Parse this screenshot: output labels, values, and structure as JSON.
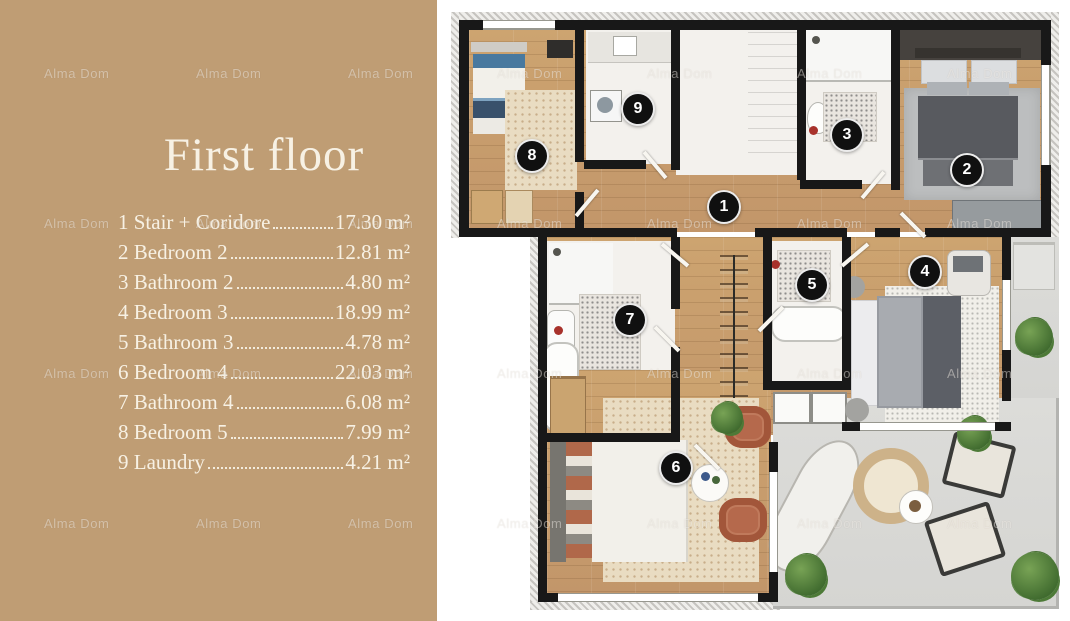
{
  "panel": {
    "title": "First floor",
    "legend": [
      {
        "num": "1",
        "label": "Stair + Coridore",
        "area": "17.30 m²"
      },
      {
        "num": "2",
        "label": "Bedroom 2",
        "area": "12.81 m²"
      },
      {
        "num": "3",
        "label": "Bathroom 2",
        "area": "4.80 m²"
      },
      {
        "num": "4",
        "label": "Bedroom 3",
        "area": "18.99 m²"
      },
      {
        "num": "5",
        "label": "Bathroom 3",
        "area": "4.78 m²"
      },
      {
        "num": "6",
        "label": "Bedroom 4",
        "area": "22.03 m²"
      },
      {
        "num": "7",
        "label": "Bathroom 4",
        "area": "6.08 m²"
      },
      {
        "num": "8",
        "label": "Bedroom 5",
        "area": "7.99 m²"
      },
      {
        "num": "9",
        "label": "Laundry",
        "area": "4.21 m²"
      }
    ]
  },
  "watermark": {
    "text": "Alma Dom"
  },
  "plan": {
    "markers": [
      {
        "n": "1",
        "room": "stair-coridore",
        "x": 269,
        "y": 197
      },
      {
        "n": "2",
        "room": "bedroom-2",
        "x": 512,
        "y": 160
      },
      {
        "n": "3",
        "room": "bathroom-2",
        "x": 392,
        "y": 125
      },
      {
        "n": "4",
        "room": "bedroom-3",
        "x": 470,
        "y": 262
      },
      {
        "n": "5",
        "room": "bathroom-3",
        "x": 357,
        "y": 275
      },
      {
        "n": "6",
        "room": "bedroom-4",
        "x": 221,
        "y": 458
      },
      {
        "n": "7",
        "room": "bathroom-4",
        "x": 175,
        "y": 310
      },
      {
        "n": "8",
        "room": "bedroom-5",
        "x": 77,
        "y": 146
      },
      {
        "n": "9",
        "room": "laundry",
        "x": 183,
        "y": 99
      }
    ]
  },
  "colors": {
    "panel_bg": "#bf9d74",
    "panel_text": "#f7f1e4",
    "wall": "#181818",
    "wood": "#c99e6b",
    "terrace": "#d9d9d6",
    "armchair_rust": "#b5694c",
    "accent_red": "#a8322c",
    "bed_blue": "#49799f"
  }
}
